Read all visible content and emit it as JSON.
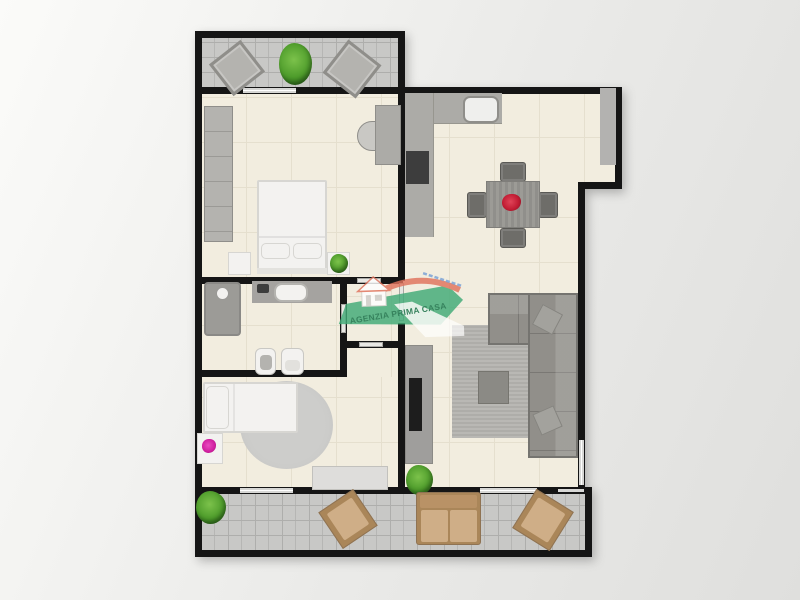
{
  "watermark": {
    "agency_name": "AGENZIA PRIMA CASA"
  },
  "colors": {
    "page-bg-1": "#fbfbf9",
    "page-bg-2": "#eaeae8",
    "page-bg-3": "#dfdfdd",
    "wall": "#151515",
    "floor": "#f2eddf",
    "floor-line": "#e5dfce",
    "tile": "#c8c8c6",
    "tile-line": "#aeaeac",
    "window": "#d7d7d5",
    "window-line": "#ffffff",
    "door": "#e8e7e3",
    "door-edge": "#a9a8a4",
    "furn-gray": "#b4b3af",
    "furn-gray-dark": "#8f8e8a",
    "furn-gray-light": "#c9c8c4",
    "counter": "#acaba7",
    "appliance": "#3d3d3d",
    "tv": "#1d1d1d",
    "sofa": "#918f8a",
    "sofa-edge": "#757470",
    "chair-dark": "#6e6d69",
    "wood": "#908f8b",
    "wood-line": "#9c9b96",
    "white-furn": "#f3f2f0",
    "white-furn-edge": "#d7d6d2",
    "rug": "#b9b8b4",
    "rug-line": "#aeada9",
    "rug-round": "#cdcdcb",
    "sideboard": "#dedddb",
    "shower": "#9c9b97",
    "plant-light": "#7cc24b",
    "plant-dark": "#2f721c",
    "flower-red": "#c21d34",
    "flower-magenta": "#cf1f9e",
    "tan-frame": "#aa8659",
    "tan-cushion": "#cfae87",
    "tan-back": "#b99266",
    "wm-green": "#41ab77",
    "wm-text": "#0d6b41",
    "wm-roof": "#e0725c",
    "wm-blue": "#5b8fd4"
  },
  "floorplan": {
    "rooms": [
      {
        "name": "terrace-top",
        "furniture": [
          "lounge-chair",
          "plant",
          "lounge-chair"
        ]
      },
      {
        "name": "bedroom-main",
        "furniture": [
          "wardrobe",
          "desk",
          "desk-chair",
          "double-bed",
          "pillow",
          "pillow",
          "nightstand",
          "nightstand",
          "plant"
        ]
      },
      {
        "name": "bathroom",
        "furniture": [
          "shower",
          "vanity",
          "sink",
          "bidet",
          "toilet"
        ]
      },
      {
        "name": "hallway",
        "furniture": []
      },
      {
        "name": "bedroom-second",
        "furniture": [
          "single-bed",
          "round-rug",
          "flower-table",
          "sideboard"
        ]
      },
      {
        "name": "kitchen-living-room",
        "furniture": [
          "kitchen-counter",
          "sink",
          "cooktop",
          "tall-cabinet",
          "dining-table",
          "flower-centerpiece",
          "dining-chair",
          "dining-chair",
          "dining-chair",
          "dining-chair",
          "sectional-sofa",
          "throw-pillow",
          "throw-pillow",
          "rug",
          "ottoman",
          "tv-console",
          "tv",
          "plant"
        ]
      },
      {
        "name": "terrace-bottom",
        "furniture": [
          "plant",
          "armchair",
          "loveseat",
          "armchair"
        ]
      }
    ]
  }
}
